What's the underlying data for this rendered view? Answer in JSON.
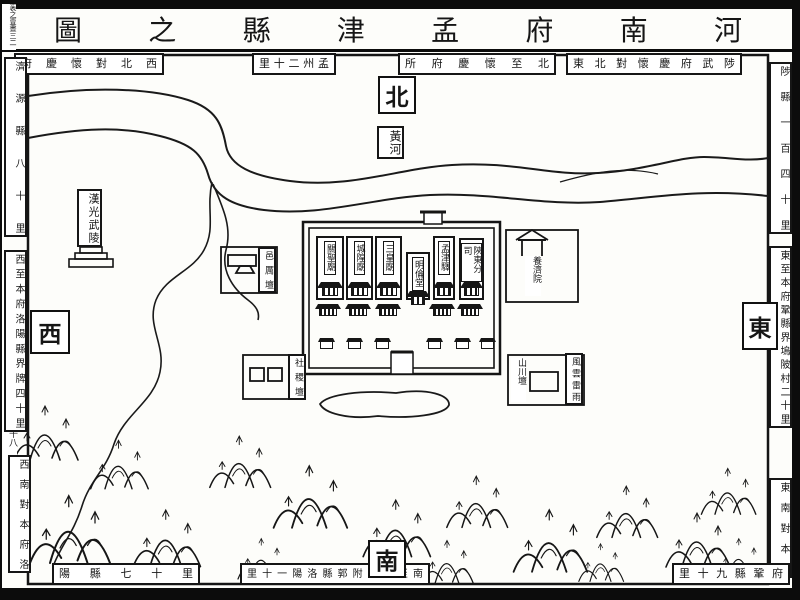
{
  "title": "河南府孟津縣之圖",
  "page_marks": {
    "volume": "袠之壹晝三二",
    "sheet": "二十八"
  },
  "cardinals": {
    "north": "北",
    "south": "南",
    "east": "東",
    "west": "西"
  },
  "border_labels": {
    "top_left": "西北對懷慶府",
    "top_mid_left": "孟州二十里",
    "top_mid_right": "北至懷慶府所",
    "top_right": "東北對懷慶府武陟",
    "left_top": "濟源縣八十里",
    "left_mid": "西至本府洛陽縣界牌四十里",
    "left_bottom": "西南對本府洛",
    "right_top": "陟縣一百四十里",
    "right_mid": "東至本府鞏縣界塢陂村二十里",
    "right_bottom": "東南對本府",
    "bottom_left": "陽縣七十里",
    "bottom_mid": "南至本府附郭縣洛陽一十里",
    "bottom_right": "府鞏縣九十里"
  },
  "features": {
    "river": "黃河",
    "tomb": "漢光武陵",
    "yili_altar": "邑厲壇",
    "sheji_altar": "社稷壇",
    "shanchuan_altar": "山川壇",
    "fengyun_altar": "風雲雷雨",
    "almshouse": "養濟院"
  },
  "city": {
    "buildings": [
      "關聖廟",
      "城隍廟",
      "三皇廟",
      "明倫堂",
      "孟津驛",
      "陝東分司"
    ]
  }
}
